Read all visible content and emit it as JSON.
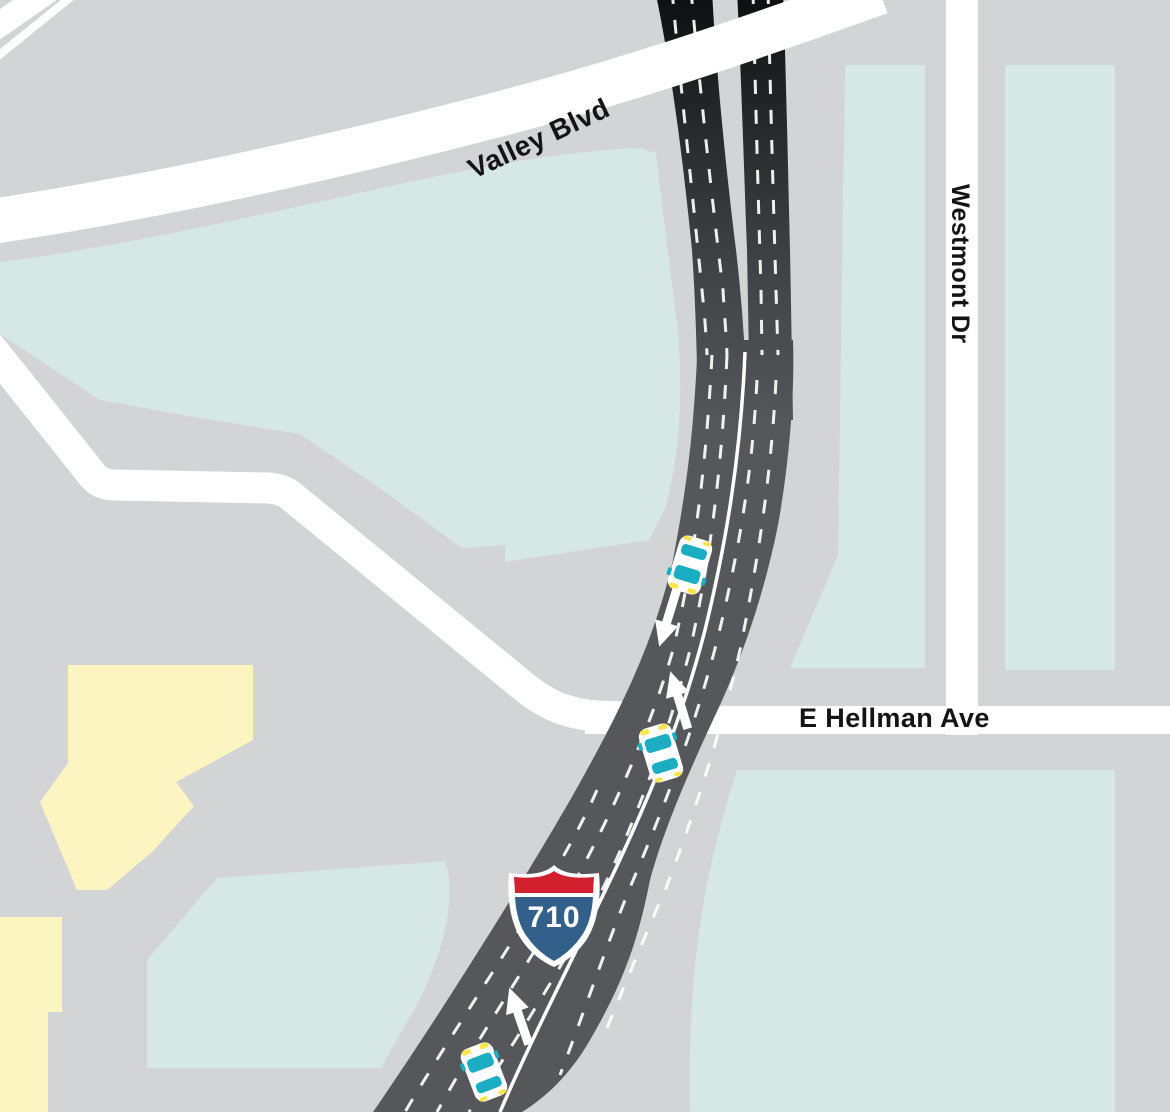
{
  "map": {
    "type": "stylized-street-map",
    "labels": {
      "street_valley": "Valley Blvd",
      "street_westmont": "Westmont Dr",
      "street_hellman": "E Hellman Ave"
    },
    "shield": {
      "route_number": "710",
      "kind": "interstate-shield"
    },
    "traffic": {
      "southbound_cars": 1,
      "northbound_cars": 2,
      "arrow_meaning": "travel direction"
    },
    "icons": [
      "car-icon",
      "direction-arrow-icon",
      "interstate-710-shield-icon"
    ],
    "colors": {
      "background_gray": "#d3d4d6",
      "parcel_teal": "#d6e8e3",
      "building_yellow": "#fcf5c1",
      "road_white": "#ffffff",
      "freeway_gray": "#56575b",
      "freeway_dark_top": "#0f1012",
      "lane_marking_white": "#ffffff",
      "car_window_teal": "#1badc2",
      "car_light_yellow": "#fbe54d",
      "shield_red": "#d2202f",
      "shield_blue": "#33608b",
      "label_black": "#141414"
    }
  }
}
